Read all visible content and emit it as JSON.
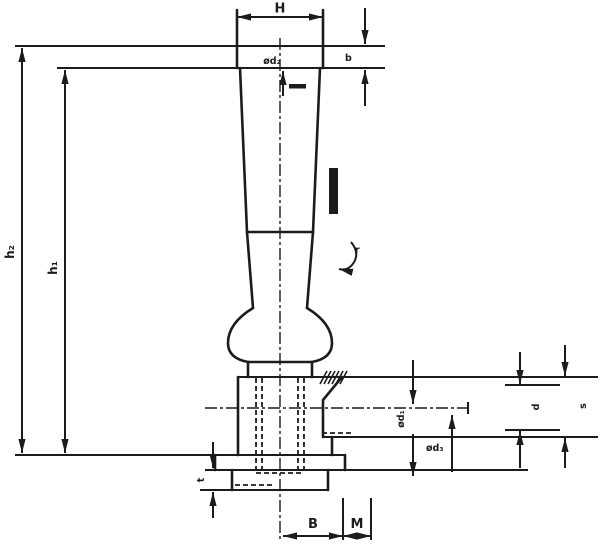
{
  "drawing": {
    "colors": {
      "line": "#1c1c1c",
      "background": "#ffffff"
    },
    "dimensions": {
      "top_width": "H",
      "cap_height": "b",
      "top_bore": "ød₂",
      "outer_height": "h₂",
      "inner_height": "h₁",
      "radius": "r",
      "flange_thickness": "t",
      "base_width": "B",
      "thread": "M",
      "bore": "ød₁",
      "counterbore": "ød₃",
      "hole_upper": "d",
      "hole_lower": "s"
    }
  }
}
